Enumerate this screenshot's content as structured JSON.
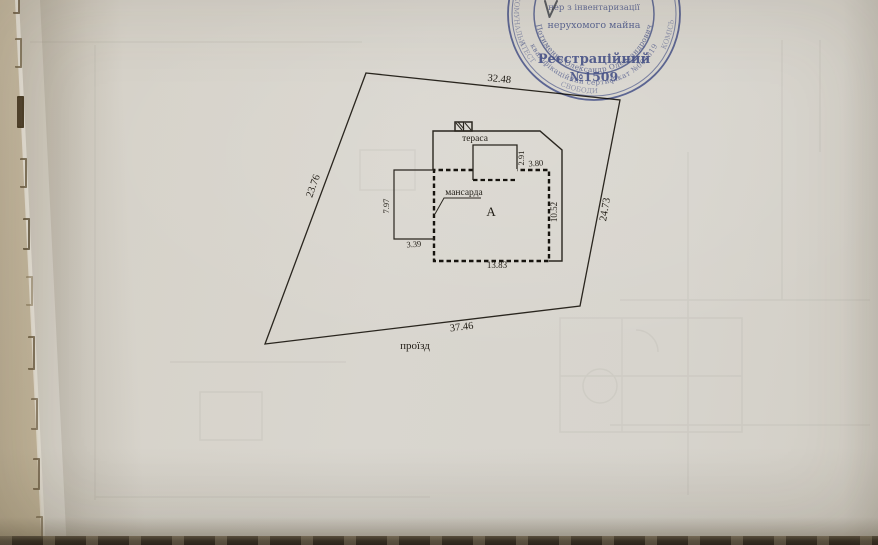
{
  "stamp": {
    "ink_color": "#44549e",
    "inner_line1": "нер з інвентаризації",
    "inner_line2": "нерухомого майна",
    "inner_line3": "Реєстраційний",
    "inner_line4": "№1509",
    "arc_name": "Потименко Олександр Олександрович",
    "arc_certificate": "кваліфікаційний сертифікат №001819",
    "ring_fragments": [
      "КОМУНАЛЬН",
      "АТЕСТ",
      "СВОБОДИ",
      "КОМІСЬ"
    ]
  },
  "site_plan": {
    "parcel": {
      "dim_top": "32.48",
      "dim_left": "23.76",
      "dim_right": "24.73",
      "dim_bottom": "37.46",
      "road_label": "проїзд"
    },
    "building": {
      "letter": "А",
      "terrace_label": "тераса",
      "mansard_label": "мансарда",
      "dim_main_width": "13.83",
      "dim_main_height": "10.52",
      "dim_notch_height": "2.91",
      "dim_notch_width": "3.80",
      "dim_wing_height": "7.97",
      "dim_wing_width": "3.39"
    }
  }
}
